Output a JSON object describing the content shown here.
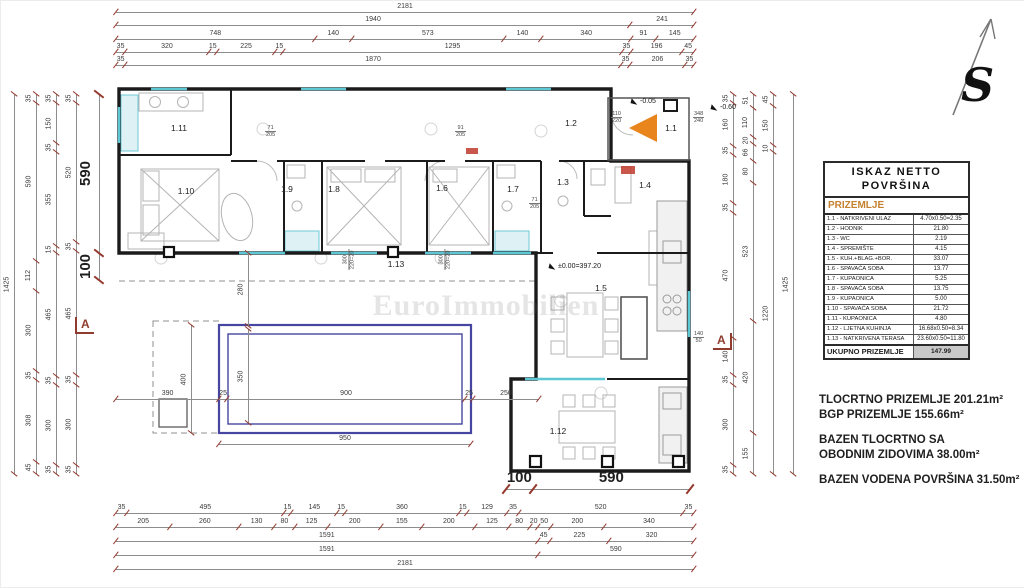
{
  "north": {
    "label": "S"
  },
  "watermark": {
    "text": "EuroImmobilien"
  },
  "rooms": {
    "r1": "1.1",
    "r2": "1.2",
    "r3": "1.3",
    "r4": "1.4",
    "r5": "1.5",
    "r6": "1.6",
    "r7": "1.7",
    "r8": "1.8",
    "r9": "1.9",
    "r10": "1.10",
    "r11": "1.11",
    "r12": "1.12",
    "r13": "1.13"
  },
  "levels": {
    "floor": "±0.00=397.20",
    "entry": "-0.05",
    "outside": "-0.60"
  },
  "section": {
    "label": "A"
  },
  "legend": {
    "title_line1": "ISKAZ NETTO",
    "title_line2": "POVRŠINA",
    "subtitle": "PRIZEMLJE",
    "rows": [
      {
        "label": "1.1 - NATKRIVENI ULAZ",
        "value": "4.70x0.50=2.35"
      },
      {
        "label": "1.2 - HODNIK",
        "value": "21.80"
      },
      {
        "label": "1.3 - WC",
        "value": "2.19"
      },
      {
        "label": "1.4 - SPREMIŠTE",
        "value": "4.15"
      },
      {
        "label": "1.5 - KUH.+BLAG.+BOR.",
        "value": "33.07"
      },
      {
        "label": "1.6 - SPAVAĆA SOBA",
        "value": "13.77"
      },
      {
        "label": "1.7 - KUPAONICA",
        "value": "5.25"
      },
      {
        "label": "1.8 - SPAVAĆA SOBA",
        "value": "13.75"
      },
      {
        "label": "1.9 - KUPAONICA",
        "value": "5.00"
      },
      {
        "label": "1.10 - SPAVAĆA SOBA",
        "value": "21.72"
      },
      {
        "label": "1.11 - KUPAONICA",
        "value": "4.80"
      },
      {
        "label": "1.12 - LJETNA KUHINJA",
        "value": "16.68x0.50=8.34"
      },
      {
        "label": "1.13 - NATKRIVENA TERASA",
        "value": "23.60x0.50=11.80"
      }
    ],
    "total_label": "UKUPNO PRIZEMLJE",
    "total_value": "147.99"
  },
  "summary": {
    "line1": "TLOCRTNO PRIZEMLJE 201.21m²",
    "line2": "BGP PRIZEMLJE 155.66m²",
    "line3": "BAZEN TLOCRTNO SA",
    "line4": "OBODNIM ZIDOVIMA 38.00m²",
    "line5": "BAZEN VODENA POVRŠINA 31.50m²"
  },
  "dims": {
    "top1": [
      "2181"
    ],
    "top2": [
      "1940",
      "241"
    ],
    "top3": [
      "748",
      "140",
      "573",
      "140",
      "340",
      "91",
      "145"
    ],
    "top4": [
      "35",
      "320",
      "15",
      "225",
      "15",
      "1295",
      "35",
      "196",
      "45"
    ],
    "top5": [
      "35",
      "1870",
      "35",
      "206",
      "35"
    ],
    "bottom1": [
      "35",
      "495",
      "15",
      "145",
      "15",
      "360",
      "15",
      "129",
      "35",
      "520",
      "35"
    ],
    "bottom2": [
      "205",
      "260",
      "130",
      "80",
      "125",
      "200",
      "155",
      "200",
      "125",
      "80",
      "20",
      "50",
      "200",
      "340"
    ],
    "bottom3": [
      "1591",
      "45",
      "225",
      "320"
    ],
    "bottom4": [
      "1591",
      "590"
    ],
    "bottom5": [
      "2181"
    ],
    "left1": [
      "1425"
    ],
    "left2": [
      "35",
      "590",
      "112",
      "300",
      "35",
      "308",
      "45"
    ],
    "left3": [
      "35",
      "150",
      "35",
      "355",
      "15",
      "465",
      "35",
      "300",
      "35"
    ],
    "left4": [
      "35",
      "520",
      "35",
      "465",
      "35",
      "300",
      "35"
    ],
    "right1": [
      "35",
      "160",
      "35",
      "180",
      "35",
      "470",
      "140",
      "35",
      "300",
      "35"
    ],
    "right2": [
      "51",
      "110",
      "20",
      "66",
      "80",
      "523",
      "420",
      "155"
    ],
    "right3": [
      "45",
      "150",
      "10",
      "1220"
    ],
    "right4": [
      "1425"
    ],
    "big_left": [
      "590",
      "100"
    ],
    "big_bottom": [
      "100",
      "590"
    ],
    "pool_width": [
      "390",
      "25",
      "900",
      "25",
      "250"
    ],
    "pool_outer": [
      "950"
    ],
    "pool_side": [
      "400"
    ],
    "pool_inner": [
      "350"
    ],
    "terrace_depth": [
      "280"
    ]
  },
  "window_tags": [
    {
      "top": "110",
      "bottom": "220"
    },
    {
      "top": "348",
      "bottom": "240"
    },
    {
      "top": "71",
      "bottom": "205"
    },
    {
      "top": "91",
      "bottom": "205"
    },
    {
      "top": "71",
      "bottom": "205"
    },
    {
      "top": "140",
      "bottom": "50"
    },
    {
      "top": "300",
      "bottom": "220=20"
    },
    {
      "top": "300",
      "bottom": "220=20"
    }
  ]
}
